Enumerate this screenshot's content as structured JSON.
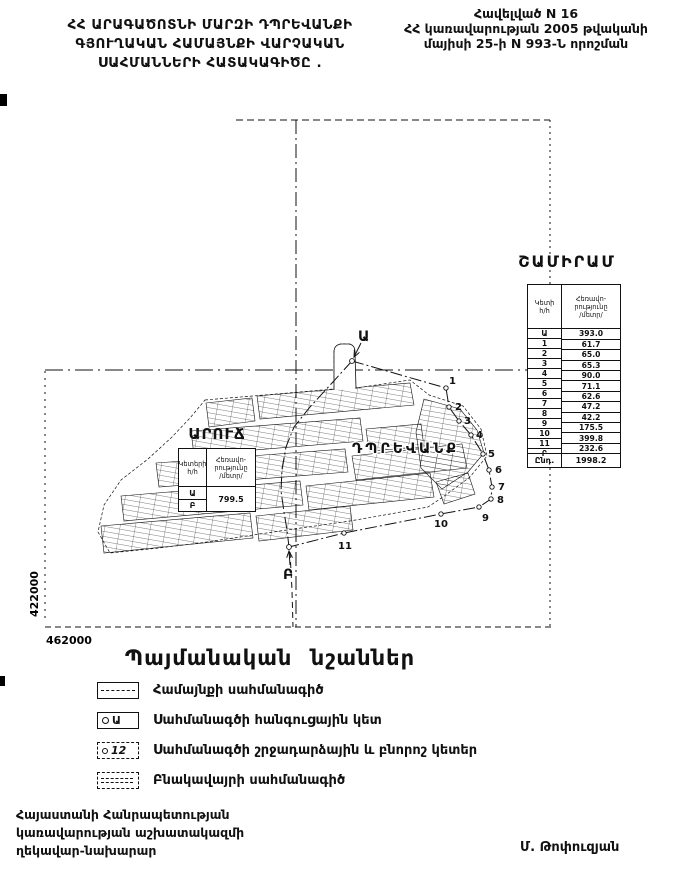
{
  "header": {
    "left_title_lines": [
      "ՀՀ ԱՐԱԳԱԾՈՏՆԻ ՄԱՐԶԻ ԴՊՐԵՎԱՆՔԻ",
      "ԳՅՈՒՂԱԿԱՆ ՀԱՄԱՅՆՔԻ ՎԱՐՉԱԿԱՆ",
      "ՍԱՀՄԱՆՆԵՐԻ ՀԱՏԱԿԱԳԻԾԸ ."
    ],
    "right_note_lines": [
      "Հավելված N 16",
      "ՀՀ կառավարության 2005 թվականի",
      "մայիսի 25-ի N 993-Ն որոշման"
    ]
  },
  "map": {
    "grid_label_left": "422000",
    "grid_label_bottom": "462000",
    "settlement_label": "ԴՊՐԵՎԱՆՔ",
    "point_labels": [
      "Ա",
      "1",
      "2",
      "3",
      "4",
      "5",
      "6",
      "7",
      "8",
      "9",
      "10",
      "11",
      "Բ"
    ]
  },
  "aruch_table": {
    "title": "ԱՐՈՒՃ",
    "col1_header_line1": "Կետերի",
    "col1_header_line2": "հ/հ",
    "col2_header_line1": "Հեռավո-",
    "col2_header_line2": "րությունը",
    "col2_header_line3": "/մետր/",
    "points": [
      "Ա",
      "Բ"
    ],
    "distance": "799.5"
  },
  "shamiram_table": {
    "title": "ՇԱՄԻՐԱՄ",
    "col1_header_line1": "Կետի",
    "col1_header_line2": "հ/հ",
    "col2_header_line1": "Հեռավո-",
    "col2_header_line2": "րությունը",
    "col2_header_line3": "/մետր/",
    "points": [
      "Ա",
      "1",
      "2",
      "3",
      "4",
      "5",
      "6",
      "7",
      "8",
      "9",
      "10",
      "11",
      "Բ"
    ],
    "distances": [
      "393.0",
      "61.7",
      "65.0",
      "65.3",
      "90.0",
      "71.1",
      "62.6",
      "47.2",
      "42.2",
      "175.5",
      "399.8",
      "232.6"
    ],
    "total_label": "Ընդ.",
    "total_value": "1998.2"
  },
  "legend": {
    "title": "Պայմանական նշաններ",
    "items": [
      {
        "label": "Համայնքի սահմանագիծ"
      },
      {
        "label": "Սահմանագծի հանգուցային կետ",
        "mark": "Ա"
      },
      {
        "label": "Սահմանագծի շրջադարձային և բնորոշ կետեր",
        "mark": "12"
      },
      {
        "label": "Բնակավայրի սահմանագիծ"
      }
    ]
  },
  "footer": {
    "left_lines": [
      "Հայաստանի Հանրապետության",
      "կառավարության աշխատակազմի",
      "ղեկավար-նախարար"
    ],
    "signature": "Մ. Թոփուզյան"
  },
  "colors": {
    "ink": "#111111",
    "paper": "#ffffff"
  }
}
